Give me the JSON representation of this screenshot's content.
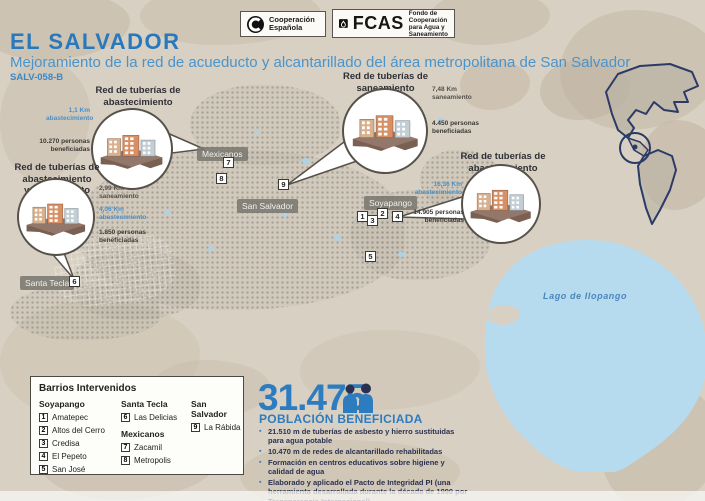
{
  "palette": {
    "accent_blue": "#2e7cc0",
    "subtitle_blue": "#4a94cc",
    "dark_navy": "#2a3150",
    "map_beige": "#d8d0c2",
    "lake_blue": "#b7dbee"
  },
  "header": {
    "country": "EL SALVADOR",
    "subtitle": "Mejoramiento de la red de acueducto y alcantarillado del área metropolitana de San Salvador",
    "code": "SALV-058-B"
  },
  "logos": {
    "aecid": {
      "line1": "Cooperación",
      "line2": "Española"
    },
    "fcas": {
      "acronym": "FCAS",
      "line1": "Fondo de Cooperación",
      "line2": "para Agua y Saneamiento"
    }
  },
  "map": {
    "labels": {
      "mexicanos": "Mexicanos",
      "san_salvador": "San Salvador",
      "soyapango": "Soyapango",
      "santa_tecla": "Santa Tecla",
      "lake": "Lago de Ilopango"
    },
    "markers": [
      "1",
      "2",
      "3",
      "4",
      "5",
      "6",
      "7",
      "8",
      "9"
    ]
  },
  "callouts": [
    {
      "lines": [
        "Red de tuberías de",
        "abastecimiento"
      ],
      "stats": [
        {
          "value": "1,1 Km",
          "label": "abastecimiento"
        },
        {
          "value": "10.270 personas",
          "label": "beneficiadas"
        }
      ]
    },
    {
      "lines": [
        "Red de tuberías de",
        "saneamiento"
      ],
      "stats": [
        {
          "value": "7,48 Km",
          "label": "saneamiento"
        },
        {
          "value": "4.450 personas",
          "label": "beneficiadas"
        }
      ]
    },
    {
      "lines": [
        "Red de tuberías de",
        "abastecimiento"
      ],
      "stats": [
        {
          "value": "16,36 Km",
          "label": "abastecimiento"
        },
        {
          "value": "14.905 personas",
          "label": "beneficiadas"
        }
      ]
    },
    {
      "lines": [
        "Red de tuberías de",
        "abastecimiento",
        "y saneamiento"
      ],
      "stats": [
        {
          "value": "2,99 Km",
          "label": "saneamiento"
        },
        {
          "value": "4,06 Km",
          "label": "abastecimiento"
        },
        {
          "value": "1.850 personas",
          "label": "beneficiadas"
        }
      ]
    }
  ],
  "legend": {
    "title": "Barrios Intervenidos",
    "groups": [
      {
        "name": "Soyapango",
        "items": [
          {
            "num": "1",
            "label": "Amatepec"
          },
          {
            "num": "2",
            "label": "Altos del Cerro"
          },
          {
            "num": "3",
            "label": "Credisa"
          },
          {
            "num": "4",
            "label": "El Pepeto"
          },
          {
            "num": "5",
            "label": "San José"
          }
        ]
      },
      {
        "name": "Santa Tecla",
        "items": [
          {
            "num": "6",
            "label": "Las Delicias"
          }
        ]
      },
      {
        "name": "Mexicanos",
        "items": [
          {
            "num": "7",
            "label": "Zacamil"
          },
          {
            "num": "8",
            "label": "Metropolis"
          }
        ]
      },
      {
        "name": "San Salvador",
        "items": [
          {
            "num": "9",
            "label": "La Rábida"
          }
        ]
      }
    ]
  },
  "stats": {
    "population": "31.475",
    "population_label": "POBLACIÓN BENEFICIADA",
    "bullets": [
      "21.510 m de tuberías de asbesto y hierro sustituidas para agua potable",
      "10.470 m de redes de alcantarillado rehabilitadas",
      "Formación en centros educativos sobre higiene y calidad de agua",
      "Elaborado y aplicado el Pacto de Integridad PI (una herramienta desarrollada durante la década de 1990 por Transparencia Internacional)"
    ]
  }
}
